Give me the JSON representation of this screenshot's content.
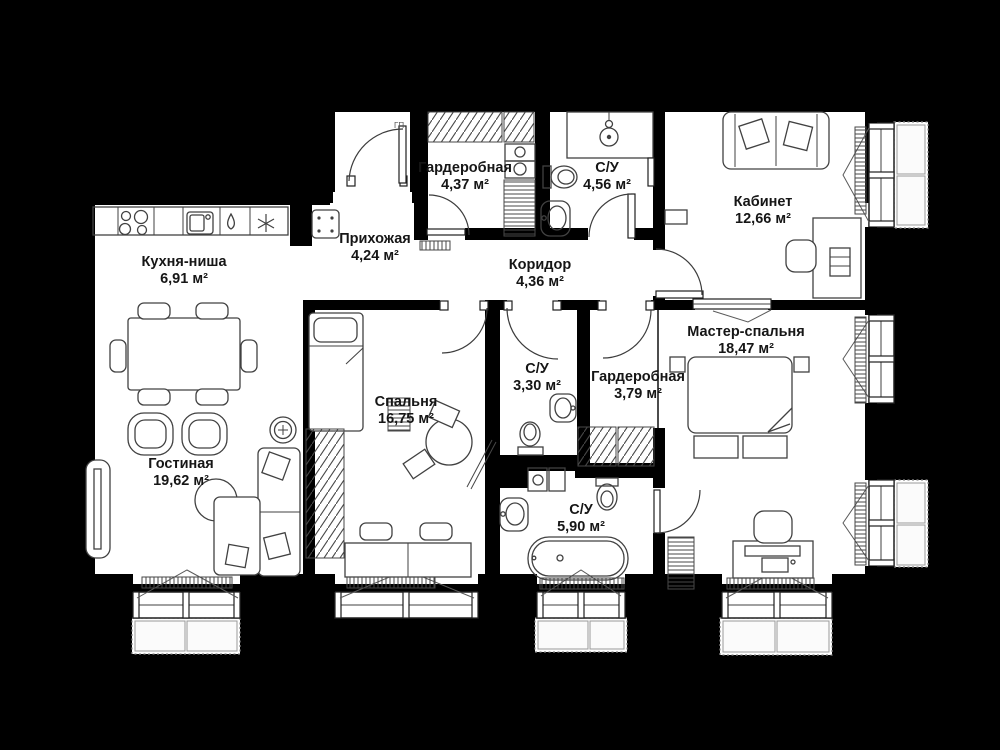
{
  "colors": {
    "background": "#000000",
    "floor": "#ffffff",
    "wall": "#000000",
    "furniture_line": "#414141",
    "label_text": "#161616"
  },
  "entry_door_mark": "ГП",
  "rooms": [
    {
      "id": "kitchen",
      "name": "Кухня-ниша",
      "area": "6,91 м²"
    },
    {
      "id": "hallway",
      "name": "Прихожая",
      "area": "4,24 м²"
    },
    {
      "id": "wardrobe-entry",
      "name": "Гардеробная",
      "area": "4,37 м²"
    },
    {
      "id": "bathroom-entry",
      "name": "С/У",
      "area": "4,56 м²"
    },
    {
      "id": "study",
      "name": "Кабинет",
      "area": "12,66 м²"
    },
    {
      "id": "corridor",
      "name": "Коридор",
      "area": "4,36 м²"
    },
    {
      "id": "bedroom",
      "name": "Спальня",
      "area": "16,75 м²"
    },
    {
      "id": "bathroom-bedroom",
      "name": "С/У",
      "area": "3,30 м²"
    },
    {
      "id": "wardrobe-master",
      "name": "Гардеробная",
      "area": "3,79 м²"
    },
    {
      "id": "master-bedroom",
      "name": "Мастер-спальня",
      "area": "18,47 м²"
    },
    {
      "id": "living-room",
      "name": "Гостиная",
      "area": "19,62 м²"
    },
    {
      "id": "bathroom-master",
      "name": "С/У",
      "area": "5,90 м²"
    }
  ]
}
